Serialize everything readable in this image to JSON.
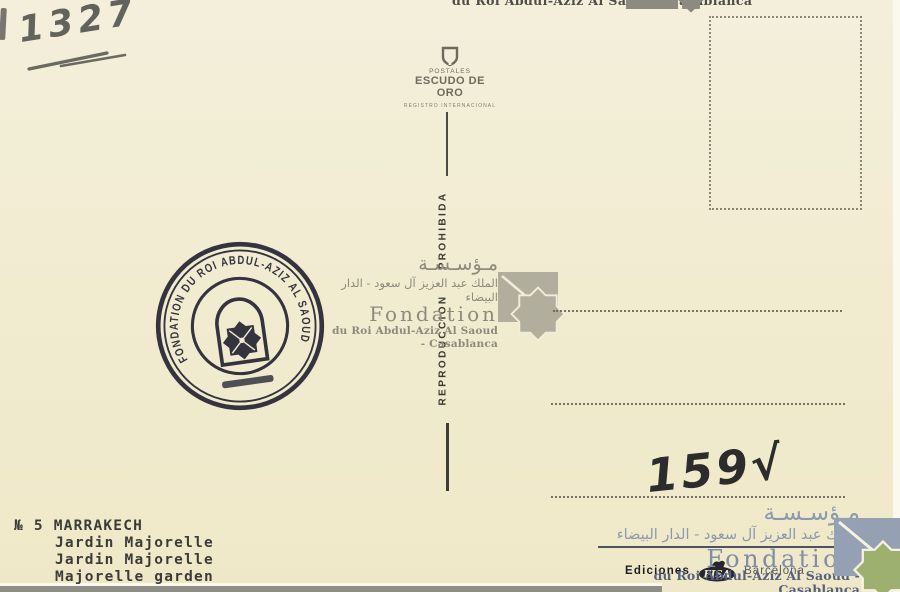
{
  "postcard": {
    "handwriting": {
      "catalog_number": "1327",
      "price_note": "159√"
    },
    "publisher_mark": {
      "line1": "POSTALES",
      "line2": "ESCUDO DE ORO",
      "line3": "REGISTRO INTERNACIONAL",
      "icon": "shield-icon"
    },
    "divider": {
      "prohibition": "REPRODUCCION PROHIBIDA"
    },
    "seal": {
      "text": "FONDATION DU ROI ABDUL-AZIZ AL SAOUD",
      "icon": "arch-and-star-seal"
    },
    "watermark": {
      "arabic_line1": "مـؤسـسـة",
      "arabic_line2": "الملك عبد العزيز آل سعود - الدار البيضاء",
      "latin_line1": "Fondation",
      "latin_line2": "du Roi Abdul-Aziz Al Saoud - Casablanca",
      "logo_icon": "eight-point-star"
    },
    "caption": {
      "line1": "№ 5 MARRAKECH",
      "line2": "Jardin Majorelle",
      "line3": "Jardin Majorelle",
      "line4": "Majorelle garden"
    },
    "imprint": {
      "publisher": "Ediciones",
      "logo_text": "FISA",
      "city": "Barcelona"
    },
    "colors": {
      "background": "#f1ecd1",
      "seal_ink": "#262634",
      "pencil": "#63635d",
      "watermark_gray": "#8d8a7c",
      "watermark_blue": "#8c99ae",
      "star_green": "#9db06f"
    }
  }
}
